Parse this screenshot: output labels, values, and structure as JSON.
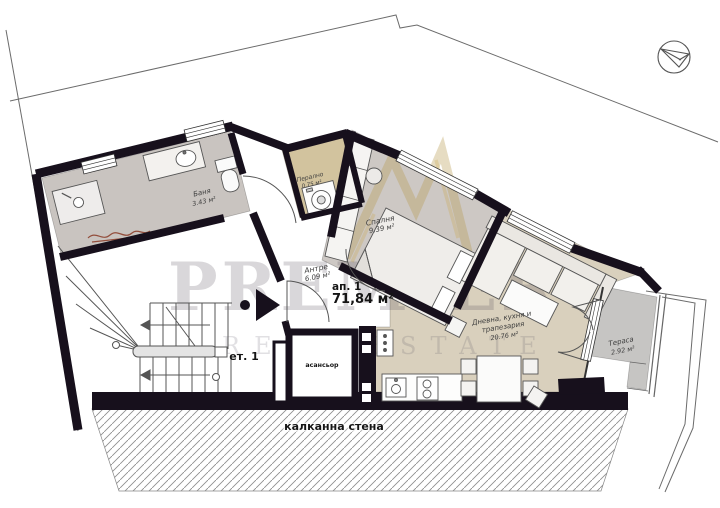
{
  "plan": {
    "unit": {
      "label": "ап. 1",
      "area": "71,84 м²"
    },
    "floor": {
      "label": "ет. 1"
    },
    "rooms": {
      "bath": {
        "name": "Баня",
        "area": "3.43 м²"
      },
      "laundry": {
        "name": "Перално",
        "area": "0.75 м²"
      },
      "hall": {
        "name": "Антре",
        "area": "6.09 м²"
      },
      "bedroom": {
        "name": "Спалня",
        "area": "9.39 м²"
      },
      "living": {
        "name_line1": "Дневна, кухня и",
        "name_line2": "трапезария",
        "area": "20.76 м²"
      },
      "terrace": {
        "name": "Тераса",
        "area": "2.92 м²"
      },
      "elevator": {
        "name": "асансьор"
      }
    },
    "party_wall": {
      "label": "калканна стена"
    },
    "watermark": {
      "line1": "PREMIER",
      "line2": "REAL ESTATE"
    },
    "icons": {
      "compass": "compass-north-icon",
      "entrance_arrow": "entrance-arrow-icon"
    },
    "colors": {
      "wall": "#17101c",
      "floor_gray": "#cbc6c2",
      "floor_tan": "#d9d0bd",
      "laundry_tan": "#d6c9a8",
      "terrace_gray": "#c6c5c3",
      "watermark_gold": "#b79b50",
      "signature_red": "#8a3a26"
    }
  }
}
